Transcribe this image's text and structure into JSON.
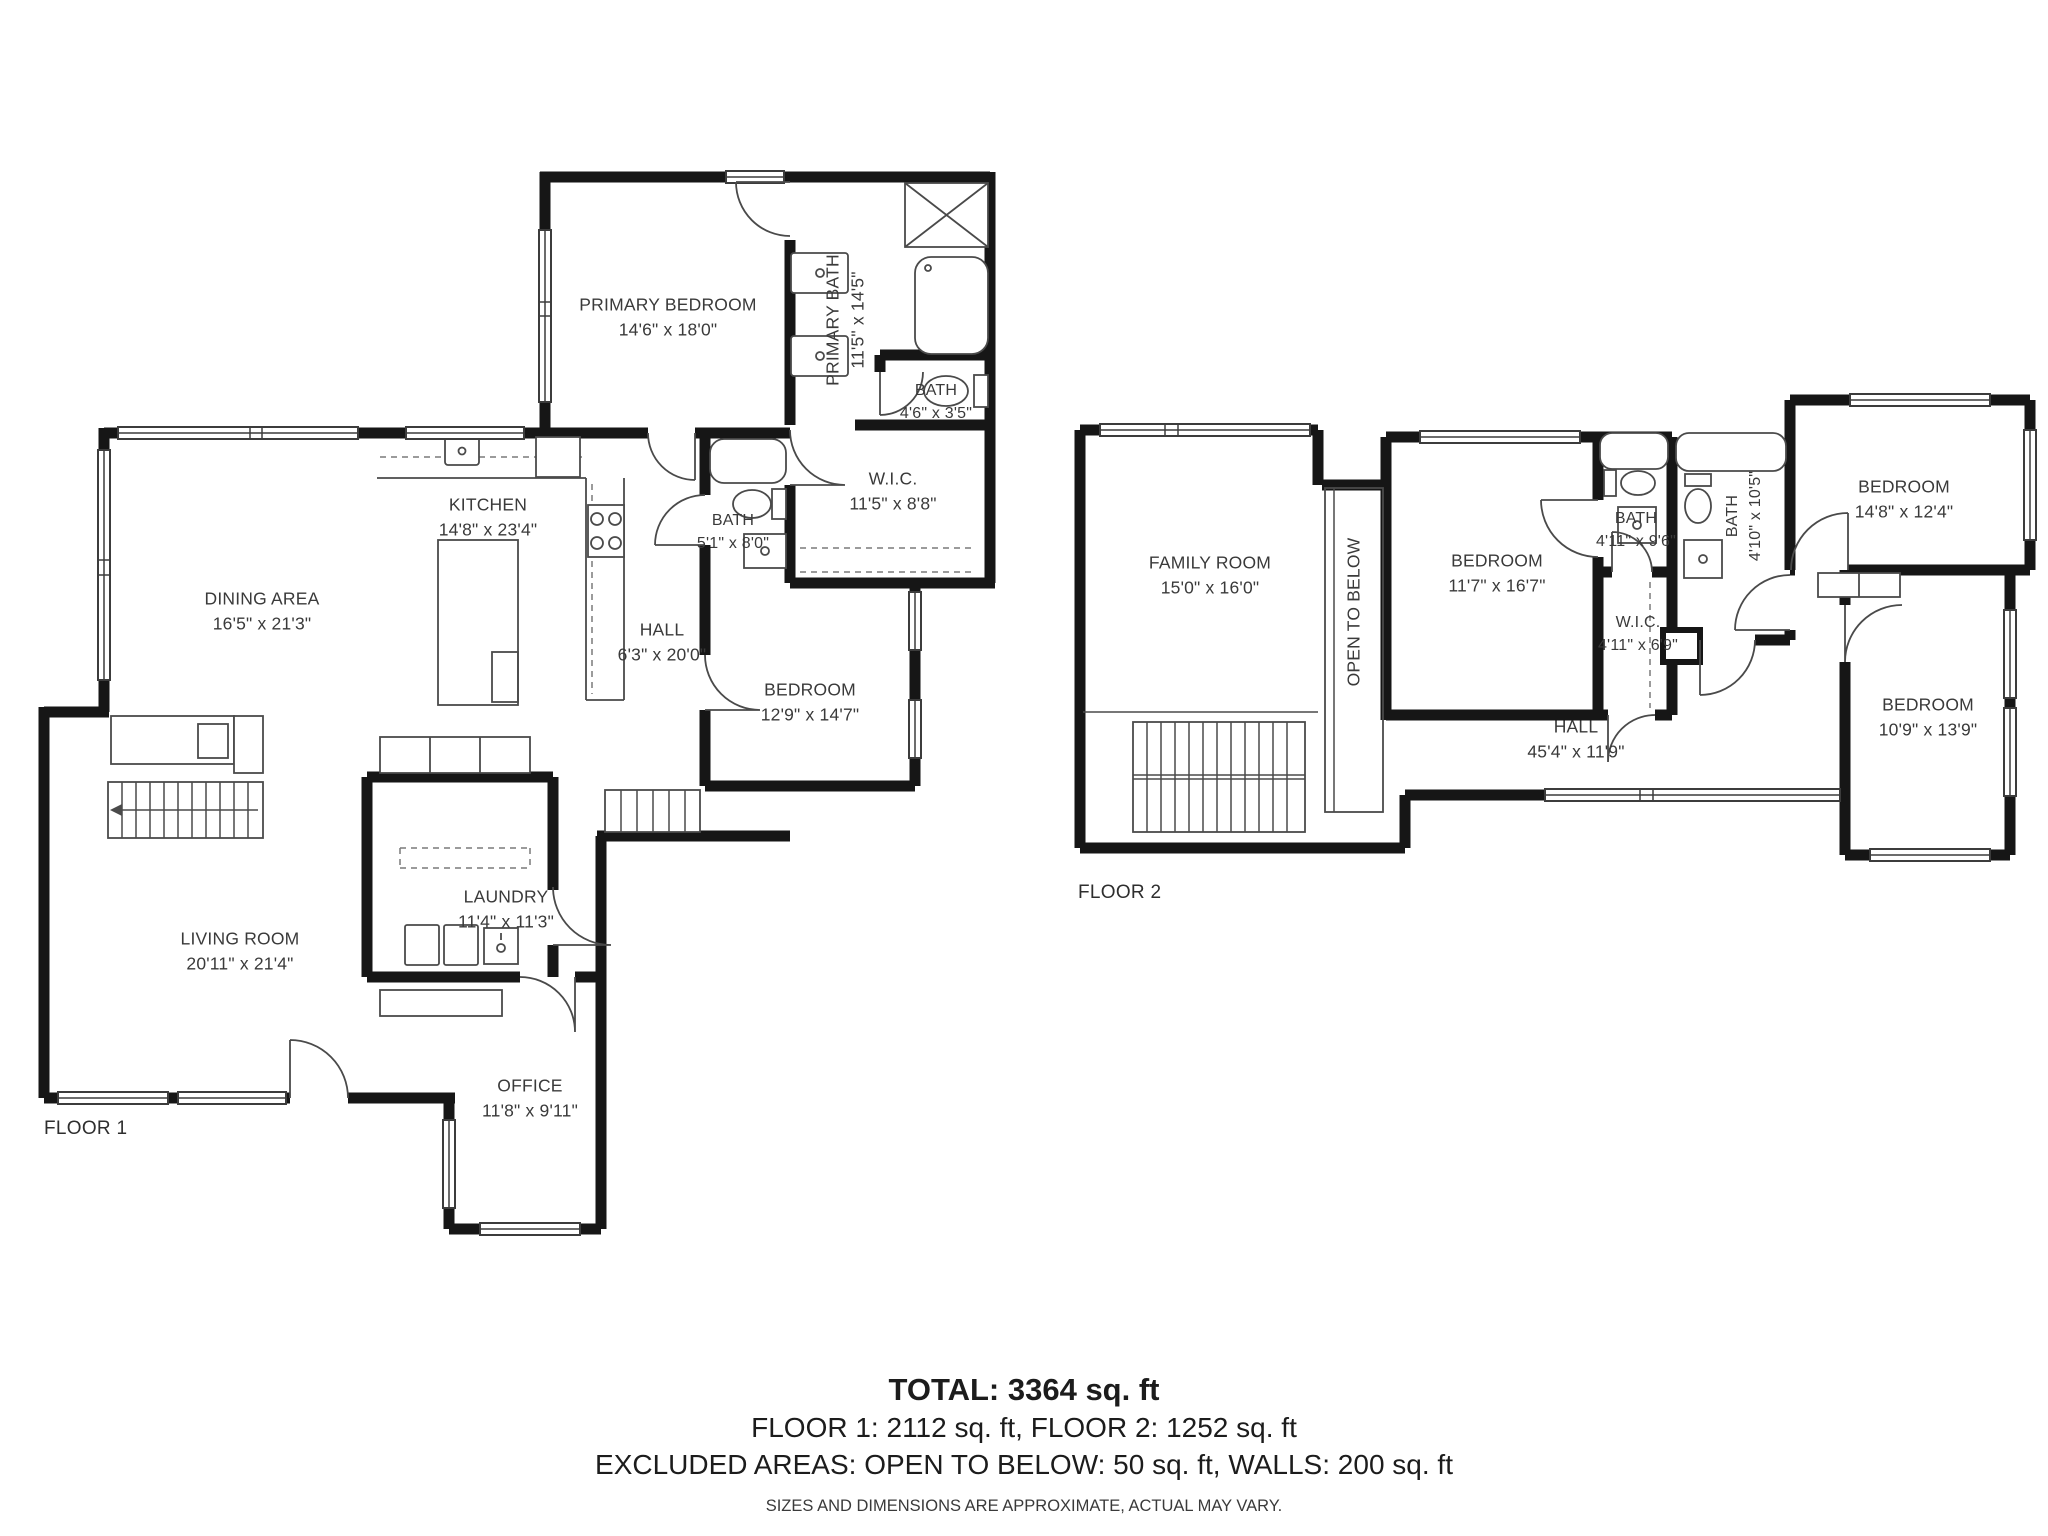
{
  "floor1": {
    "label": "FLOOR 1",
    "rooms": [
      {
        "name": "PRIMARY BEDROOM",
        "dims": "14'6\" x 18'0\""
      },
      {
        "name": "PRIMARY BATH",
        "dims": "11'5\" x 14'5\""
      },
      {
        "name": "BATH",
        "dims": "4'6\" x 3'5\""
      },
      {
        "name": "W.I.C.",
        "dims": "11'5\" x 8'8\""
      },
      {
        "name": "BATH",
        "dims": "5'1\" x 8'0\""
      },
      {
        "name": "KITCHEN",
        "dims": "14'8\" x 23'4\""
      },
      {
        "name": "DINING AREA",
        "dims": "16'5\" x 21'3\""
      },
      {
        "name": "HALL",
        "dims": "6'3\" x 20'0\""
      },
      {
        "name": "BEDROOM",
        "dims": "12'9\" x 14'7\""
      },
      {
        "name": "LIVING ROOM",
        "dims": "20'11\" x 21'4\""
      },
      {
        "name": "LAUNDRY",
        "dims": "11'4\" x 11'3\""
      },
      {
        "name": "OFFICE",
        "dims": "11'8\" x 9'11\""
      }
    ]
  },
  "floor2": {
    "label": "FLOOR 2",
    "rooms": [
      {
        "name": "FAMILY ROOM",
        "dims": "15'0\" x 16'0\""
      },
      {
        "name": "OPEN TO BELOW",
        "dims": ""
      },
      {
        "name": "BEDROOM",
        "dims": "11'7\" x 16'7\""
      },
      {
        "name": "BATH",
        "dims": "4'11\" x 9'6\""
      },
      {
        "name": "W.I.C.",
        "dims": "4'11\" x 6'9\""
      },
      {
        "name": "BATH",
        "dims": "4'10\" x 10'5\""
      },
      {
        "name": "BEDROOM",
        "dims": "14'8\" x 12'4\""
      },
      {
        "name": "HALL",
        "dims": "45'4\" x 11'9\""
      },
      {
        "name": "BEDROOM",
        "dims": "10'9\" x 13'9\""
      }
    ]
  },
  "footer": {
    "total": "TOTAL: 3364 sq. ft",
    "floors": "FLOOR 1: 2112 sq. ft, FLOOR 2: 1252 sq. ft",
    "excluded": "EXCLUDED AREAS: OPEN TO BELOW: 50 sq. ft, WALLS: 200 sq. ft",
    "disclaimer": "SIZES AND DIMENSIONS ARE APPROXIMATE, ACTUAL MAY VARY."
  }
}
